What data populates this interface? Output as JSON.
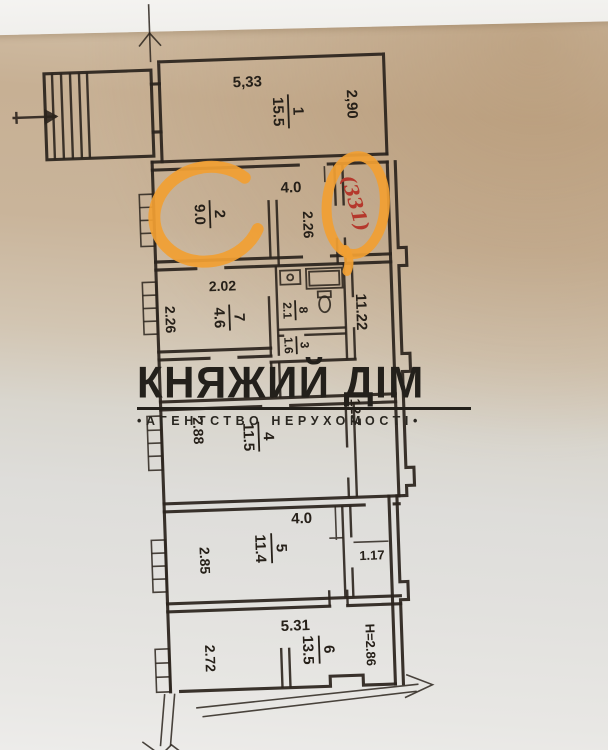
{
  "watermark": {
    "title": "КНЯЖИЙ ДІМ",
    "subtitle": "•АГЕНТСТВО НЕРУХОМОСТІ•"
  },
  "annotation": {
    "unit_number": "(331)"
  },
  "rooms": {
    "r1": {
      "number": "1",
      "area": "15.5"
    },
    "r2": {
      "number": "2",
      "area": "9.0"
    },
    "r3": {
      "number": "3",
      "area": "1.6"
    },
    "r4": {
      "number": "4",
      "area": "11.5"
    },
    "r5": {
      "number": "5",
      "area": "11.4"
    },
    "r6": {
      "number": "6",
      "area": "13.5"
    },
    "r7": {
      "number": "7",
      "area": "4.6"
    },
    "r8": {
      "number": "8",
      "area": "2.1"
    }
  },
  "dimensions": {
    "room1_width": "5,33",
    "room1_side": "2,90",
    "hall_width": "4.0",
    "hall_side": "2.26",
    "room7_width": "2.02",
    "room7_side": "2.26",
    "corridor_length": "11.22",
    "corridor_area": "12.7",
    "room4_side": "2.88",
    "room5_width": "4.0",
    "room5_side": "2.85",
    "passage_width": "1.17",
    "room6_width": "5.31",
    "room6_side": "2.72",
    "ceiling_height": "Н=2.86"
  },
  "colors": {
    "paper_warm": "#c8b196",
    "ink": "#2b241d",
    "highlight_orange": "#f19f33",
    "handwritten_red": "#b5382c"
  }
}
